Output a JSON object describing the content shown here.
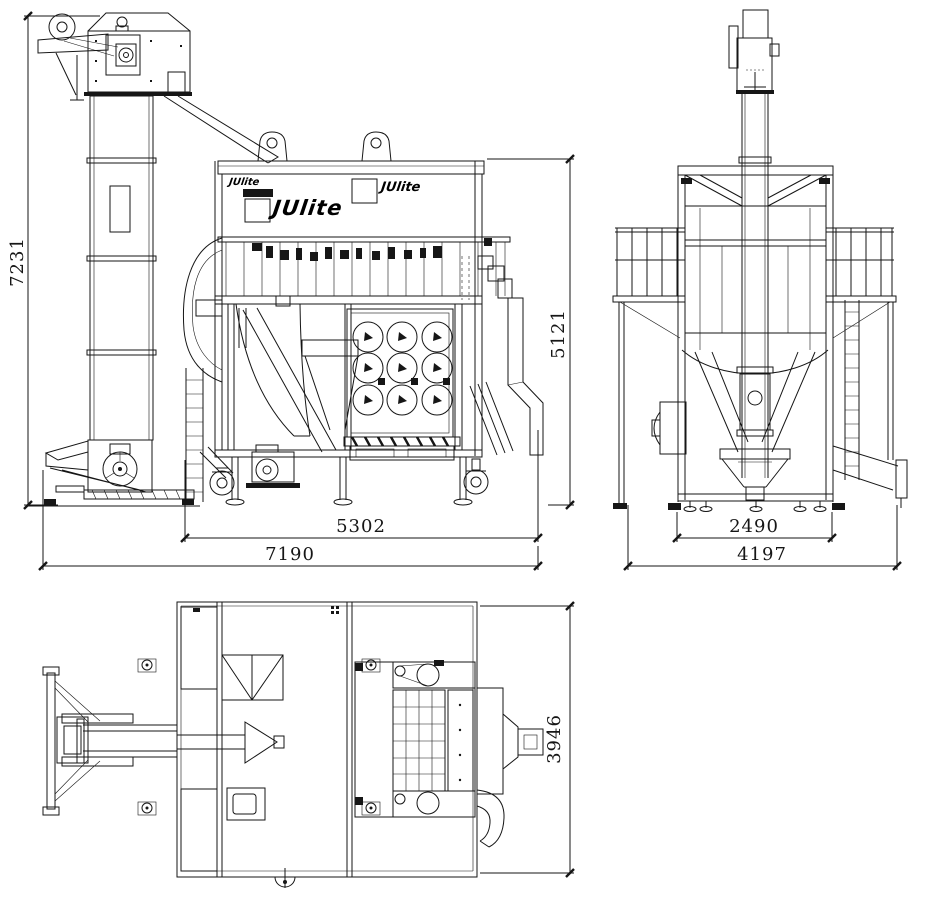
{
  "brand": {
    "large_logo": "JUlite",
    "small_logo": "JUlite",
    "right_logo": "JUlite"
  },
  "dimensions": {
    "front_overall_height": "7231",
    "front_body_height": "5121",
    "front_body_width": "5302",
    "front_overall_width": "7190",
    "side_base_width": "2490",
    "side_overall_width": "4197",
    "top_overall_depth": "3946"
  }
}
